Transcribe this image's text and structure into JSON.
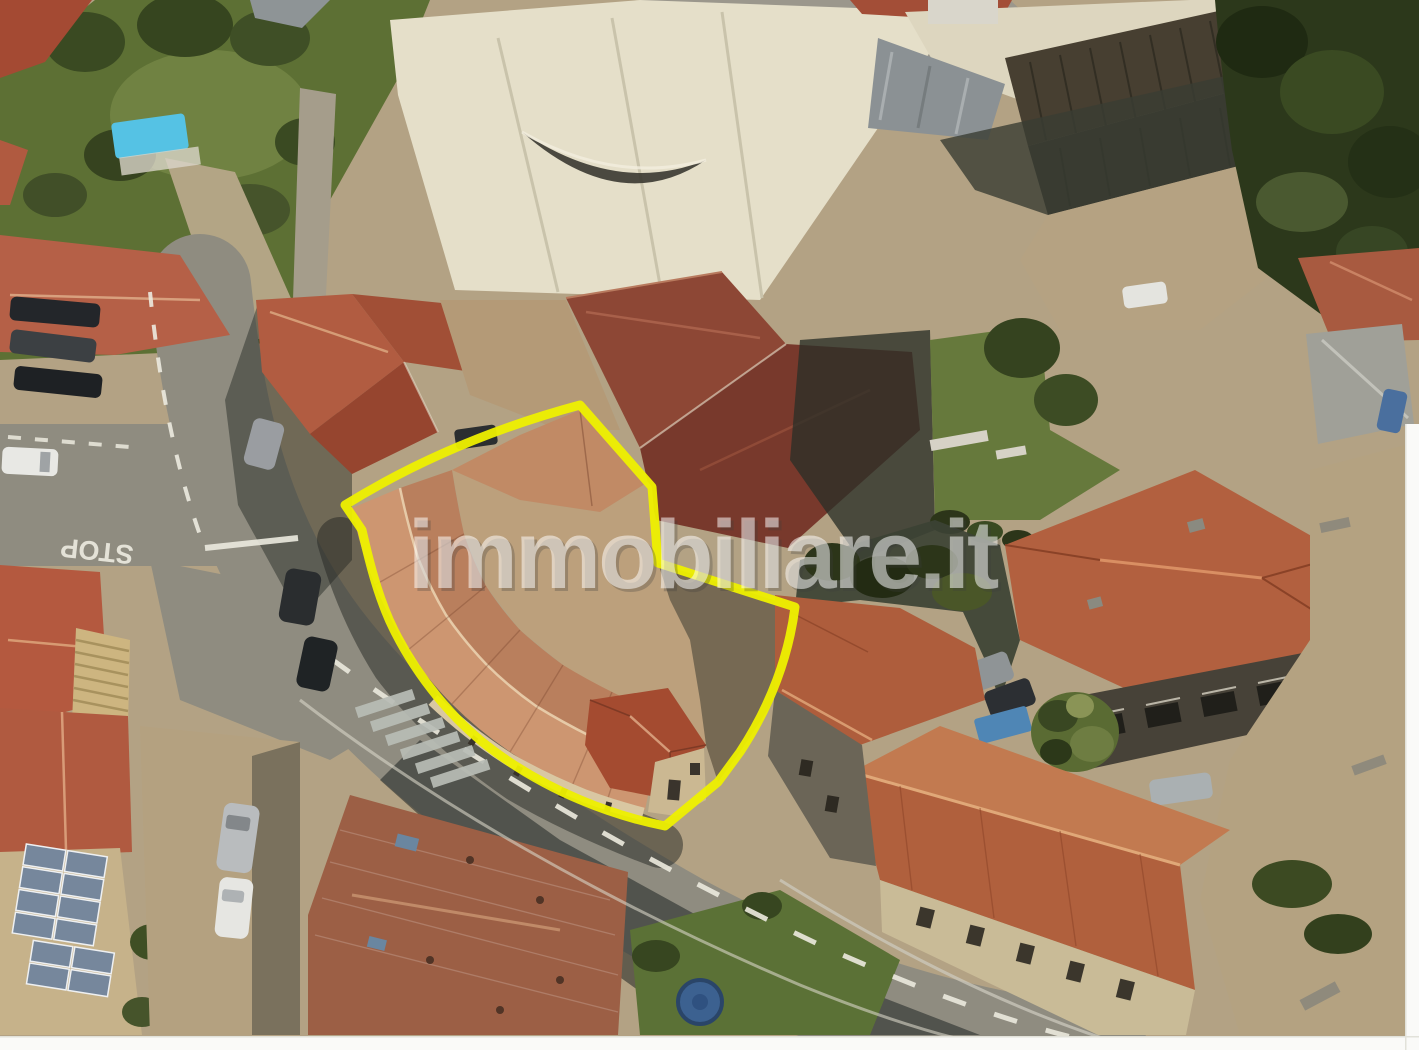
{
  "watermark": {
    "text": "immobiliare.it"
  },
  "road": {
    "stop_marking": "STOP"
  },
  "colors": {
    "property_outline": "#eef000",
    "watermark_fill": "rgba(255,255,255,0.52)",
    "watermark_shadow": "rgba(60,60,60,0.28)",
    "white_margin": "#fafaf8",
    "pool_blue": "#55c2e4",
    "road_grey": "#8f8c80",
    "warehouse_cream": "#e5dfc9",
    "grass_green": "#66793c",
    "ground_tan": "#b3a284",
    "roof_terracotta": "#cd9671",
    "roof_red": "#b2603f",
    "trampoline_blue": "#3c6190"
  }
}
